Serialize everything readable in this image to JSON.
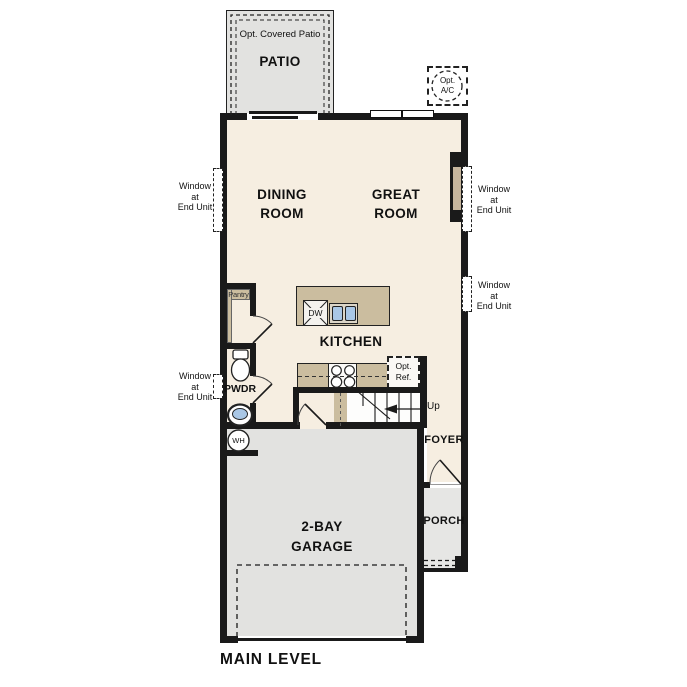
{
  "title": "MAIN LEVEL",
  "rooms": {
    "patio": "PATIO",
    "dining": "DINING\nROOM",
    "great": "GREAT\nROOM",
    "kitchen": "KITCHEN",
    "powder": "PWDR",
    "foyer": "FOYER",
    "porch": "PORCH",
    "garage": "2-BAY\nGARAGE"
  },
  "annotations": {
    "opt_covered_patio": "Opt. Covered Patio",
    "opt_ac": "Opt.\nA/C",
    "pantry": "Pantry",
    "dishwasher": "DW",
    "opt_ref": "Opt.\nRef.",
    "stairs_up": "Up",
    "water_heater": "WH",
    "window_note": "Window\nat\nEnd Unit"
  },
  "colors": {
    "wall": "#1a1a1a",
    "interior": "#f6eee1",
    "patio": "#e2e2e0",
    "garage": "#e2e2e0",
    "porch": "#e6e6e4",
    "cabinet": "#cbbd9f",
    "fireplace_insert": "#c6b69e",
    "sink_blue": "#a9c7e6"
  }
}
